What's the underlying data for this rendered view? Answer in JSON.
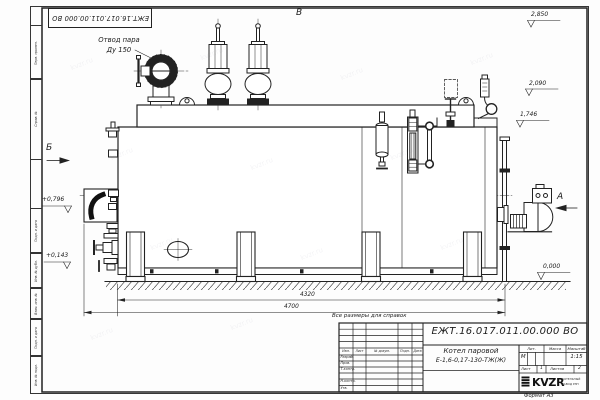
{
  "stamp": {
    "doc_number_top": "ЕЖТ.16.017.011.00.000  ВО"
  },
  "watermark": {
    "text": "kvzr.ru"
  },
  "margin_labels": {
    "perv": "Перв. примен.",
    "sprav": "Справ. №",
    "podp1": "Подп. и дата",
    "inv_dubl": "Инв. № дубл.",
    "vzam": "Взам. инв. №",
    "podp2": "Подп. и дата",
    "inv_podl": "Инв. № подл."
  },
  "drawing": {
    "callout_line1": "Отвод пара",
    "callout_line2": "Ду 150",
    "marker_a": "А",
    "marker_b": "Б",
    "marker_v": "В",
    "elev_2850": "2,850",
    "elev_2090": "2,090",
    "elev_1746": "1,746",
    "elev_0796": "+0,796",
    "elev_0143": "+0,143",
    "elev_0000": "0,000",
    "dim_4320": "4320",
    "dim_4700": "4700",
    "note": "Все размеры для справок"
  },
  "title_block": {
    "doc_number": "ЕЖТ.16.017.011.00.000  ВО",
    "name_line1": "Котел паровой",
    "name_line2": "Е-1,6-0,17-130-ТЖ(Ж)",
    "col_izm": "Изм.",
    "col_list": "Лист",
    "col_doc": "№ докум.",
    "col_podp": "Подп.",
    "col_data": "Дата",
    "row_razrab": "Разраб.",
    "row_prov": "Пров.",
    "row_tkontr": "Т.контр.",
    "row_nkontr": "Н.контр.",
    "row_utv": "Утв.",
    "hdr_lit": "Лит.",
    "hdr_massa": "Масса",
    "hdr_scale": "Масштаб",
    "lit_value": "М",
    "scale_value": "1:15",
    "sheet_label": "Лист",
    "sheet_value": "1",
    "sheets_label": "Листов",
    "sheets_value": "2",
    "logo_text": "KVZR",
    "logo_sub1": "КОТЕЛЬНЫЙ",
    "logo_sub2": "ЗАВОД РЭП",
    "format_label": "Формат А3"
  }
}
